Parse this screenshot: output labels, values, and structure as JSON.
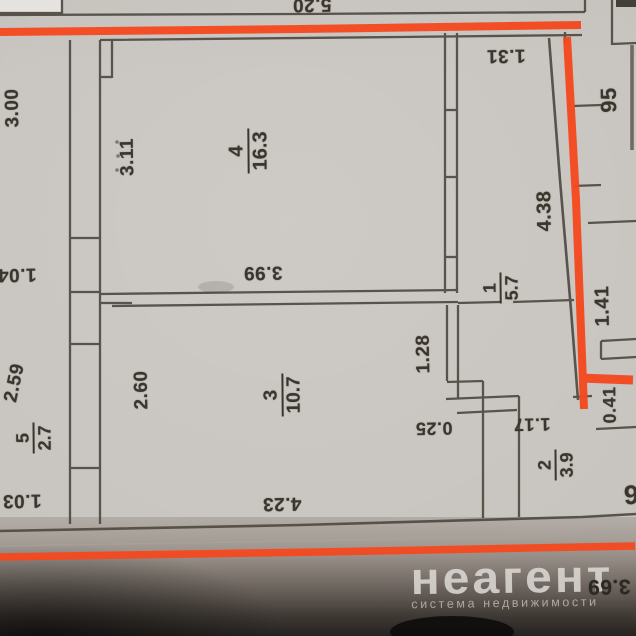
{
  "document_type": "apartment floor plan photo",
  "watermark": {
    "brand": "неагент",
    "tagline": "система недвижимости"
  },
  "colors": {
    "annotation_red": "#f5481d",
    "paper": "#c8c4bf",
    "wall_ink": "#4f4a42",
    "text_ink": "#3a352d"
  },
  "rooms": {
    "room4": {
      "number": "4",
      "area": "16.3"
    },
    "room1": {
      "number": "1",
      "area": "5.7"
    },
    "room3": {
      "number": "3",
      "area": "10.7"
    },
    "room5": {
      "number": "5",
      "area": "2.7"
    },
    "room2": {
      "number": "2",
      "area": "3.9"
    }
  },
  "dims": {
    "d520": "5.20",
    "d131": "1.31",
    "d300": "3.00",
    "d311": "3.11",
    "d95": "95",
    "d438": "4.38",
    "d141": "1.41",
    "d104": "1.04",
    "d399": "3.99",
    "d259": "2.59",
    "d260": "2.60",
    "d128": "1.28",
    "d025": "0.25",
    "d117": "1.17",
    "d103": "1.03",
    "d423": "4.23",
    "d041": "0.41",
    "partial_digit_right": "6",
    "partial_bottom_right": "3.69"
  }
}
